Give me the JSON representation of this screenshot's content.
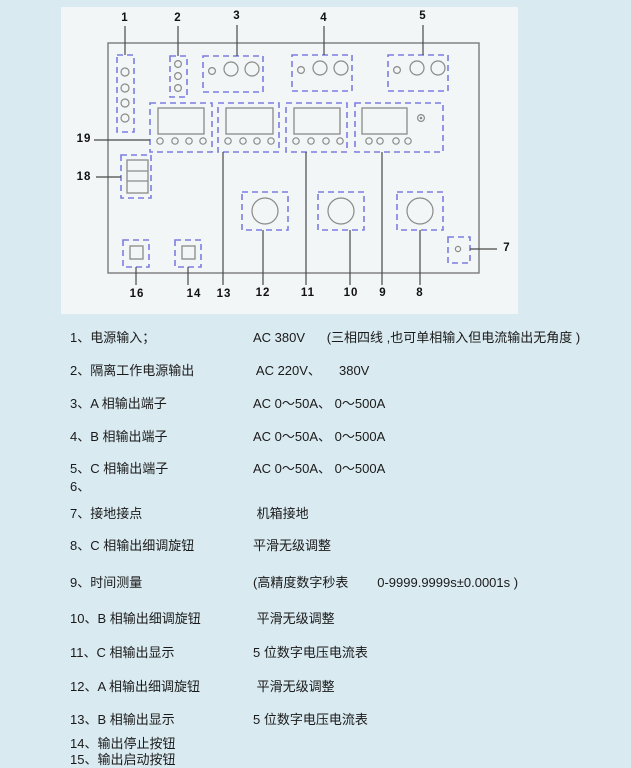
{
  "colors": {
    "page_bg": "#d9eaf1",
    "diagram_bg": "#f2f6f7",
    "dashed_outline": "#7d7de0",
    "shape_outline": "#8a8a8a",
    "text": "#1a1a1a"
  },
  "diagram": {
    "callouts": [
      "1",
      "2",
      "3",
      "4",
      "5",
      "7",
      "8",
      "9",
      "10",
      "11",
      "12",
      "13",
      "14",
      "16",
      "18",
      "19"
    ]
  },
  "legend": {
    "rows": [
      {
        "label": "1、电源输入；",
        "value": "AC 380V      (三相四线 ,也可单相输入但电流输出无角度 )"
      },
      {
        "label": "2、隔离工作电源输出",
        "value": " AC 220V、     380V"
      },
      {
        "label": "3、A 相输出端子",
        "value": "AC 0～50A、 0～500A"
      },
      {
        "label": "4、B 相输出端子",
        "value": "AC 0～50A、 0～500A"
      },
      {
        "label": "5、C 相输出端子",
        "value": "AC 0～50A、 0～500A"
      },
      {
        "label": "6、",
        "value": ""
      },
      {
        "label": "7、接地接点",
        "value": " 机箱接地"
      },
      {
        "label": "8、C 相输出细调旋钮",
        "value": "平滑无级调整"
      },
      {
        "label": "9、时间测量",
        "value": "(高精度数字秒表        0-9999.9999s±0.0001s )"
      },
      {
        "label": "10、B 相输出细调旋钮",
        "value": " 平滑无级调整"
      },
      {
        "label": "11、C 相输出显示",
        "value": "5 位数字电压电流表"
      },
      {
        "label": "12、A 相输出细调旋钮",
        "value": " 平滑无级调整"
      },
      {
        "label": "13、B 相输出显示",
        "value": "5 位数字电压电流表"
      },
      {
        "label": "14、输出停止按钮",
        "value": ""
      },
      {
        "label": "15、输出启动按钮",
        "value": ""
      }
    ]
  }
}
